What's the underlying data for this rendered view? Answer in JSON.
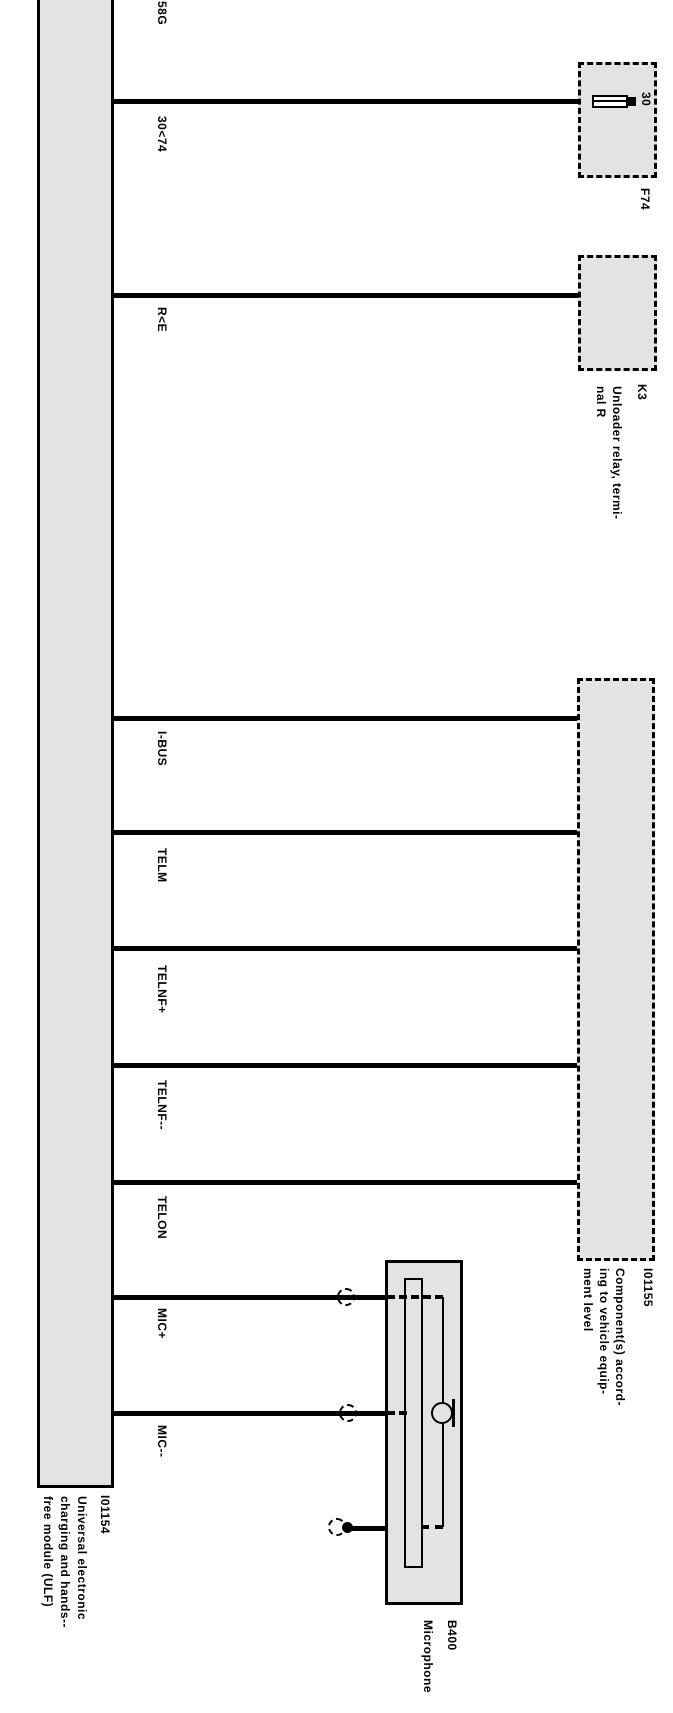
{
  "diagram": {
    "module": {
      "id": "I01154",
      "name": "Universal electronic\ncharging and hands--\nfree module (ULF)"
    },
    "wires": [
      {
        "label": "58G"
      },
      {
        "label": "30<74"
      },
      {
        "label": "R<E"
      },
      {
        "label": "I-BUS"
      },
      {
        "label": "TELM"
      },
      {
        "label": "TELNF+"
      },
      {
        "label": "TELNF--"
      },
      {
        "label": "TELON"
      },
      {
        "label": "MIC+"
      },
      {
        "label": "MIC--"
      }
    ],
    "fuse": {
      "id": "F74",
      "terminal": "30"
    },
    "relay": {
      "id": "K3",
      "name": "Unloader relay, termi-\nnal R"
    },
    "equipment": {
      "id": "I01155",
      "name": "Component(s) accord-\ning to vehicle equip-\nment level"
    },
    "microphone": {
      "id": "B400",
      "name": "Microphone"
    },
    "colors": {
      "component_fill": "#e3e3e3",
      "line": "#000000",
      "background": "#ffffff"
    }
  }
}
